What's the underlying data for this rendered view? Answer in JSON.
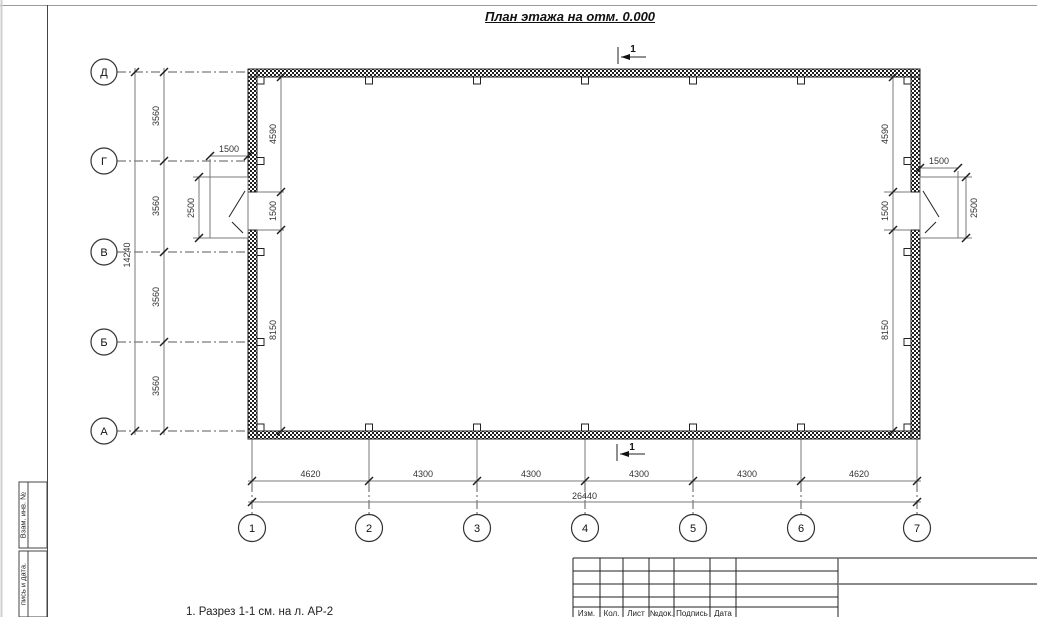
{
  "title": "План этажа на отм. 0.000",
  "caption": "1. Разрез 1-1 см. на л. АР-2",
  "section_mark": "1",
  "axes": {
    "rows": [
      "Д",
      "Г",
      "В",
      "Б",
      "А"
    ],
    "cols": [
      "1",
      "2",
      "3",
      "4",
      "5",
      "6",
      "7"
    ]
  },
  "dims": {
    "left_total": "14240",
    "left_chain": [
      "3560",
      "3560",
      "3560",
      "3560"
    ],
    "left_interior": [
      "4590",
      "1500",
      "8150"
    ],
    "right_interior": [
      "4590",
      "1500",
      "8150"
    ],
    "left_door": {
      "width": "1500",
      "depth": "2500"
    },
    "right_door": {
      "width": "1500",
      "depth": "2500"
    },
    "bottom_chain": [
      "4620",
      "4300",
      "4300",
      "4300",
      "4300",
      "4620"
    ],
    "bottom_total": "26440"
  },
  "frame": {
    "stamp_labels": [
      "Взам. инв. №",
      "пись и дата."
    ],
    "title_block_labels": [
      "Изм.",
      "Кол.",
      "Лист",
      "№док.",
      "Подпись",
      "Дата"
    ]
  },
  "colors": {
    "wall_ink": "#1f1f1f",
    "dim_line": "#7a7a7a",
    "axis_line": "#5a5a5a"
  }
}
